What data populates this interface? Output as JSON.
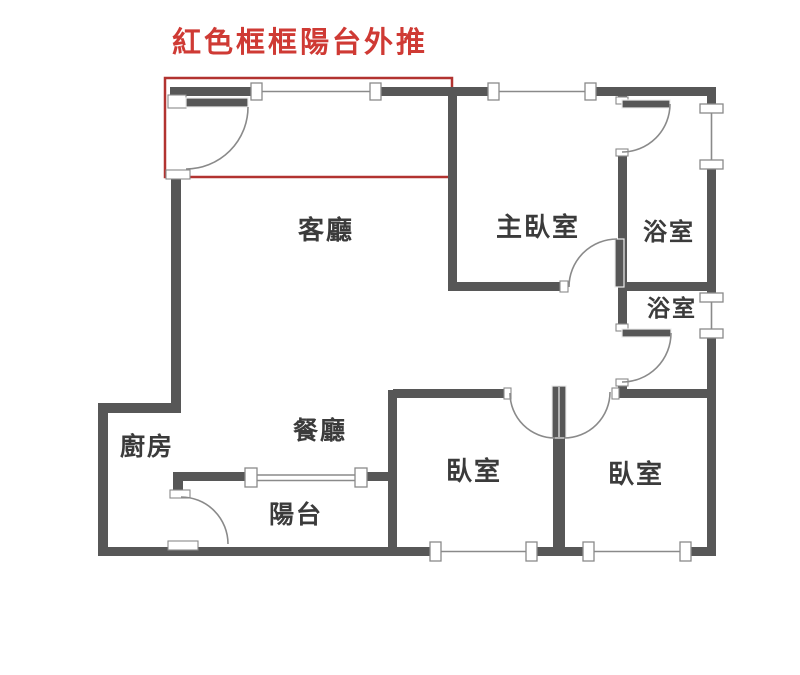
{
  "title": {
    "text": "紅色框框陽台外推"
  },
  "rooms": {
    "living": {
      "label": "客廳"
    },
    "master": {
      "label": "主臥室"
    },
    "bath1": {
      "label": "浴室"
    },
    "bath2": {
      "label": "浴室"
    },
    "kitchen": {
      "label": "廚房"
    },
    "dining": {
      "label": "餐廳"
    },
    "balcony": {
      "label": "陽台"
    },
    "bedroom1": {
      "label": "臥室"
    },
    "bedroom2": {
      "label": "臥室"
    }
  },
  "colors": {
    "wall": "#575757",
    "line": "#8a8a8a",
    "red": "#b23330",
    "redText": "#cf3a34",
    "label": "#3b3b3b",
    "bg": "#ffffff"
  }
}
